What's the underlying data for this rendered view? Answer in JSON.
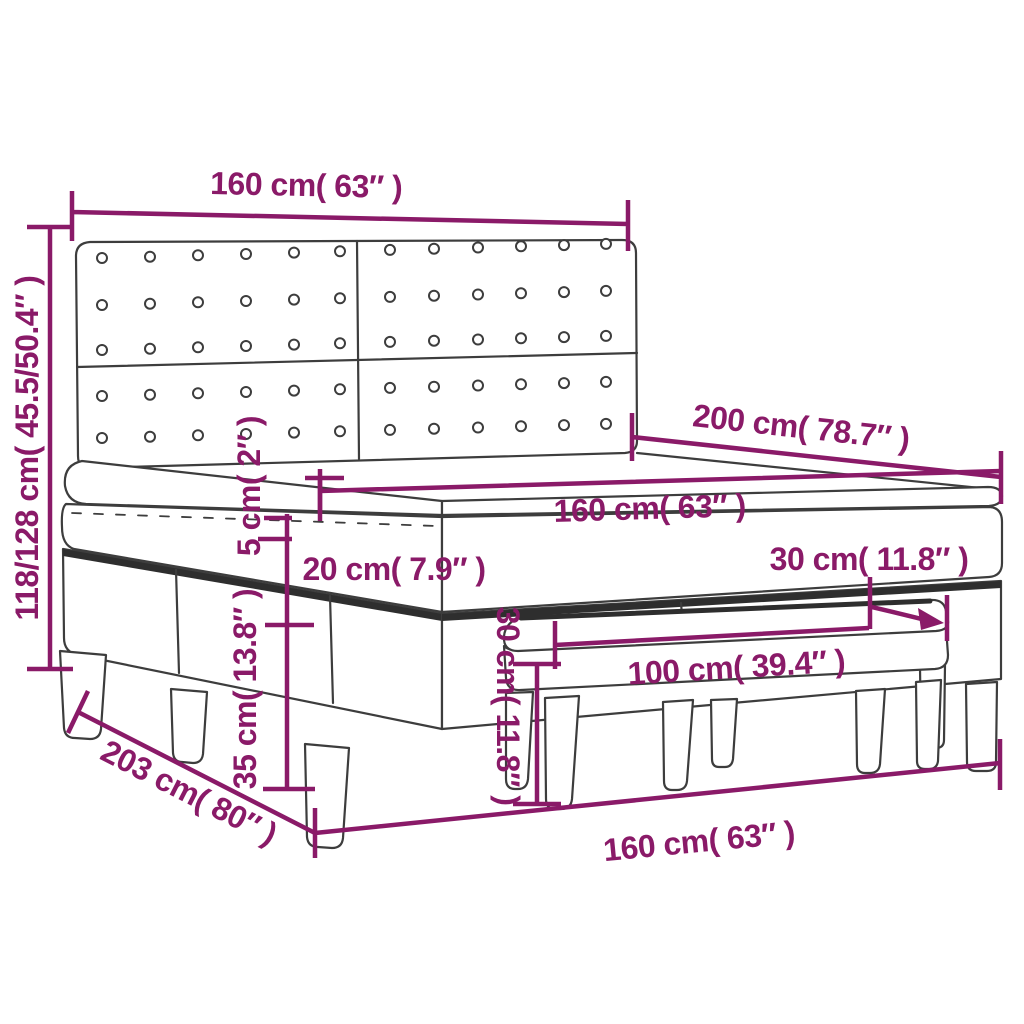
{
  "diagram": {
    "title": "Box spring bed with headboard and bench - dimension diagram",
    "accent_color": "#8A1A68",
    "line_color": "#3D3D3D",
    "background_color": "#FFFFFF",
    "dimensions": {
      "headboard_width": "160 cm( 63″ )",
      "headboard_height": "118/128 cm( 45.5/50.4″ )",
      "bed_length": "200 cm( 78.7″ )",
      "mattress_width": "160 cm( 63″ )",
      "topper_thickness": "5 cm( 2″ )",
      "mattress_thickness": "20 cm( 7.9″ )",
      "bench_depth": "30 cm( 11.8″ )",
      "bench_height": "30 cm( 11.8″ )",
      "bench_width": "100 cm( 39.4″ )",
      "base_height": "35 cm( 13.8″ )",
      "bed_total_length": "203 cm( 80″ )",
      "base_width": "160 cm( 63″ )"
    }
  }
}
